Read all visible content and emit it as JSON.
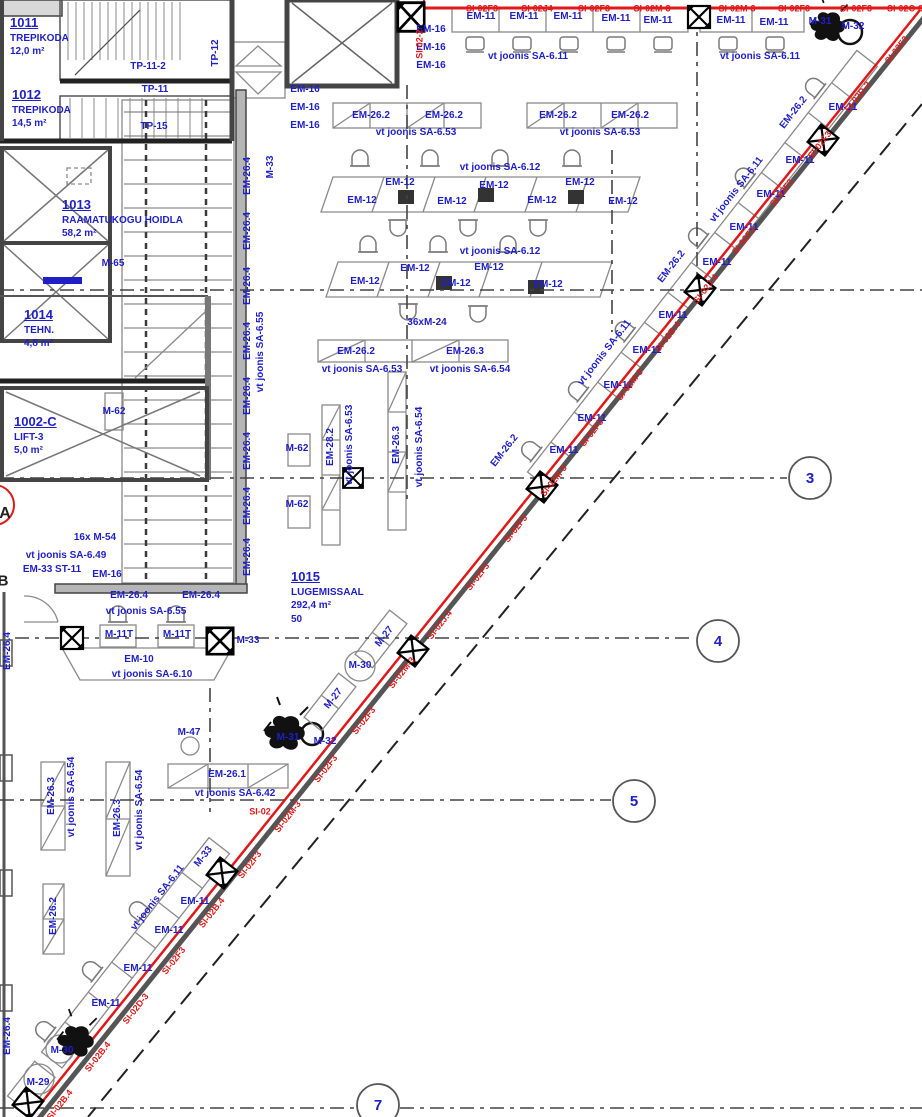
{
  "meta": {
    "type": "architectural-floor-plan",
    "width": 922,
    "height": 1117
  },
  "colors": {
    "blue": "#1f1fc8",
    "red": "#e01a1a",
    "dark": "#222"
  },
  "rooms": [
    {
      "number": "1011",
      "lines": [
        "TREPIKODA",
        "12,0 m²"
      ],
      "x": 10,
      "y": 16
    },
    {
      "number": "1012",
      "lines": [
        "TREPIKODA",
        "14,5 m²"
      ],
      "x": 12,
      "y": 88
    },
    {
      "number": "1013",
      "lines": [
        "RAAMATUKOGU HOIDLA",
        "58,2 m²"
      ],
      "x": 62,
      "y": 198
    },
    {
      "number": "1014",
      "lines": [
        "TEHN.",
        "4,8 m²"
      ],
      "x": 24,
      "y": 308
    },
    {
      "number": "1002-C",
      "lines": [
        "LIFT-3",
        "5,0 m²"
      ],
      "x": 14,
      "y": 415
    },
    {
      "number": "1015",
      "lines": [
        "LUGEMISSAAL",
        "292,4 m²",
        "50"
      ],
      "x": 291,
      "y": 570
    }
  ],
  "grid_bubbles": [
    {
      "label": "3",
      "x": 810,
      "y": 478
    },
    {
      "label": "4",
      "x": 718,
      "y": 641
    },
    {
      "label": "5",
      "x": 634,
      "y": 801
    },
    {
      "label": "7",
      "x": 378,
      "y": 1105
    }
  ],
  "labels": [
    {
      "t": "TP-11-2",
      "x": 148,
      "y": 67
    },
    {
      "t": "TP-11",
      "x": 155,
      "y": 90
    },
    {
      "t": "TP-15",
      "x": 154,
      "y": 127
    },
    {
      "t": "TP-12",
      "x": 216,
      "y": 53,
      "r": -90
    },
    {
      "t": "M-65",
      "x": 113,
      "y": 264
    },
    {
      "t": "M-62",
      "x": 114,
      "y": 412
    },
    {
      "t": "M-62",
      "x": 297,
      "y": 449
    },
    {
      "t": "M-62",
      "x": 297,
      "y": 505
    },
    {
      "t": "M-33",
      "x": 271,
      "y": 167,
      "r": -90
    },
    {
      "t": "EM-26.4",
      "x": 248,
      "y": 176,
      "r": -90
    },
    {
      "t": "EM-26.4",
      "x": 248,
      "y": 231,
      "r": -90
    },
    {
      "t": "EM-26.4",
      "x": 248,
      "y": 286,
      "r": -90
    },
    {
      "t": "EM-26.4",
      "x": 248,
      "y": 341,
      "r": -90
    },
    {
      "t": "EM-26.4",
      "x": 248,
      "y": 396,
      "r": -90
    },
    {
      "t": "EM-26.4",
      "x": 248,
      "y": 451,
      "r": -90
    },
    {
      "t": "EM-26.4",
      "x": 248,
      "y": 506,
      "r": -90
    },
    {
      "t": "EM-26.4",
      "x": 248,
      "y": 557,
      "r": -90
    },
    {
      "t": "vt joonis SA-6.55",
      "x": 261,
      "y": 352,
      "r": -90
    },
    {
      "t": "EM-16",
      "x": 431,
      "y": 30
    },
    {
      "t": "EM-16",
      "x": 431,
      "y": 48
    },
    {
      "t": "EM-16",
      "x": 431,
      "y": 66
    },
    {
      "t": "EM-16",
      "x": 305,
      "y": 90
    },
    {
      "t": "EM-16",
      "x": 305,
      "y": 108
    },
    {
      "t": "EM-16",
      "x": 305,
      "y": 126
    },
    {
      "t": "EM-26.2",
      "x": 371,
      "y": 116
    },
    {
      "t": "EM-26.2",
      "x": 444,
      "y": 116
    },
    {
      "t": "vt joonis SA-6.53",
      "x": 416,
      "y": 133
    },
    {
      "t": "EM-26.2",
      "x": 558,
      "y": 116
    },
    {
      "t": "EM-26.2",
      "x": 630,
      "y": 116
    },
    {
      "t": "vt joonis SA-6.53",
      "x": 600,
      "y": 133
    },
    {
      "t": "EM-11",
      "x": 481,
      "y": 17
    },
    {
      "t": "EM-11",
      "x": 524,
      "y": 17
    },
    {
      "t": "EM-11",
      "x": 568,
      "y": 17
    },
    {
      "t": "EM-11",
      "x": 616,
      "y": 19
    },
    {
      "t": "EM-11",
      "x": 658,
      "y": 21
    },
    {
      "t": "EM-11",
      "x": 731,
      "y": 21
    },
    {
      "t": "EM-11",
      "x": 774,
      "y": 23
    },
    {
      "t": "vt joonis SA-6.11",
      "x": 528,
      "y": 57
    },
    {
      "t": "vt joonis SA-6.11",
      "x": 760,
      "y": 57
    },
    {
      "t": "M-31",
      "x": 820,
      "y": 22
    },
    {
      "t": "M-32",
      "x": 853,
      "y": 27
    },
    {
      "t": "vt joonis SA-6.12",
      "x": 500,
      "y": 168
    },
    {
      "t": "EM-12",
      "x": 400,
      "y": 183
    },
    {
      "t": "EM-12",
      "x": 362,
      "y": 201
    },
    {
      "t": "EM-12",
      "x": 452,
      "y": 202
    },
    {
      "t": "EM-12",
      "x": 494,
      "y": 186
    },
    {
      "t": "EM-12",
      "x": 542,
      "y": 201
    },
    {
      "t": "EM-12",
      "x": 580,
      "y": 183
    },
    {
      "t": "EM-12",
      "x": 623,
      "y": 202
    },
    {
      "t": "vt joonis SA-6.12",
      "x": 500,
      "y": 252
    },
    {
      "t": "EM-12",
      "x": 415,
      "y": 269
    },
    {
      "t": "EM-12",
      "x": 365,
      "y": 282
    },
    {
      "t": "EM-12",
      "x": 456,
      "y": 284
    },
    {
      "t": "EM-12",
      "x": 489,
      "y": 268
    },
    {
      "t": "EM-12",
      "x": 548,
      "y": 285
    },
    {
      "t": "36xM-24",
      "x": 427,
      "y": 323
    },
    {
      "t": "EM-26.2",
      "x": 356,
      "y": 352
    },
    {
      "t": "EM-26.3",
      "x": 465,
      "y": 352
    },
    {
      "t": "vt joonis SA-6.53",
      "x": 362,
      "y": 370
    },
    {
      "t": "vt joonis SA-6.54",
      "x": 470,
      "y": 370
    },
    {
      "t": "EM-28.2",
      "x": 331,
      "y": 447,
      "r": -90
    },
    {
      "t": "vt joonis SA-6.53",
      "x": 350,
      "y": 445,
      "r": -90
    },
    {
      "t": "EM-26.3",
      "x": 397,
      "y": 445,
      "r": -90
    },
    {
      "t": "vt joonis SA-6.54",
      "x": 420,
      "y": 447,
      "r": -90
    },
    {
      "t": "16x M-54",
      "x": 95,
      "y": 538
    },
    {
      "t": "vt joonis SA-6.49",
      "x": 66,
      "y": 556
    },
    {
      "t": "EM-33 ST-11",
      "x": 52,
      "y": 570
    },
    {
      "t": "EM-16",
      "x": 107,
      "y": 575
    },
    {
      "t": "EM-26.4",
      "x": 129,
      "y": 596
    },
    {
      "t": "EM-26.4",
      "x": 201,
      "y": 596
    },
    {
      "t": "vt joonis SA-6.55",
      "x": 146,
      "y": 612
    },
    {
      "t": "M-11T",
      "x": 119,
      "y": 635
    },
    {
      "t": "M-11T",
      "x": 177,
      "y": 635
    },
    {
      "t": "M-33",
      "x": 248,
      "y": 641
    },
    {
      "t": "EM-10",
      "x": 139,
      "y": 660
    },
    {
      "t": "vt joonis SA-6.10",
      "x": 152,
      "y": 675
    },
    {
      "t": "EM-26.4",
      "x": 8,
      "y": 651,
      "r": -90
    },
    {
      "t": "A",
      "x": 5,
      "y": 514,
      "c": "dark",
      "s": 16
    },
    {
      "t": "B",
      "x": 3,
      "y": 581,
      "c": "dark",
      "s": 15
    },
    {
      "t": "M-27",
      "x": 385,
      "y": 637,
      "r": -52
    },
    {
      "t": "M-30",
      "x": 360,
      "y": 666
    },
    {
      "t": "M-27",
      "x": 334,
      "y": 699,
      "r": -52
    },
    {
      "t": "M-31",
      "x": 288,
      "y": 738
    },
    {
      "t": "M-32",
      "x": 325,
      "y": 742
    },
    {
      "t": "M-47",
      "x": 189,
      "y": 733
    },
    {
      "t": "EM-26.1",
      "x": 227,
      "y": 775
    },
    {
      "t": "vt joonis SA-6.42",
      "x": 235,
      "y": 794
    },
    {
      "t": "EM-11",
      "x": 843,
      "y": 108
    },
    {
      "t": "EM-11",
      "x": 800,
      "y": 161
    },
    {
      "t": "EM-11",
      "x": 771,
      "y": 195
    },
    {
      "t": "EM-11",
      "x": 744,
      "y": 228
    },
    {
      "t": "EM-11",
      "x": 717,
      "y": 263
    },
    {
      "t": "vt joonis SA-6.11",
      "x": 737,
      "y": 190,
      "r": -52
    },
    {
      "t": "EM-26.2",
      "x": 794,
      "y": 113,
      "r": -52
    },
    {
      "t": "EM-26.2",
      "x": 672,
      "y": 267,
      "r": -52
    },
    {
      "t": "EM-11",
      "x": 673,
      "y": 316
    },
    {
      "t": "EM-11",
      "x": 647,
      "y": 351
    },
    {
      "t": "EM-11",
      "x": 618,
      "y": 386
    },
    {
      "t": "EM-11",
      "x": 592,
      "y": 419
    },
    {
      "t": "EM-11",
      "x": 564,
      "y": 451
    },
    {
      "t": "vt joonis SA-6.11",
      "x": 605,
      "y": 353,
      "r": -52
    },
    {
      "t": "EM-26.2",
      "x": 505,
      "y": 451,
      "r": -52
    },
    {
      "t": "M-33",
      "x": 204,
      "y": 857,
      "r": -52
    },
    {
      "t": "vt joonis SA-6.11",
      "x": 158,
      "y": 898,
      "r": -52
    },
    {
      "t": "EM-11",
      "x": 195,
      "y": 902
    },
    {
      "t": "EM-11",
      "x": 169,
      "y": 931
    },
    {
      "t": "EM-11",
      "x": 138,
      "y": 969
    },
    {
      "t": "EM-11",
      "x": 106,
      "y": 1004
    },
    {
      "t": "EM-26.2",
      "x": 54,
      "y": 916,
      "r": -90
    },
    {
      "t": "EM-26.3",
      "x": 52,
      "y": 796,
      "r": -90
    },
    {
      "t": "vt joonis SA-6.54",
      "x": 72,
      "y": 797,
      "r": -90
    },
    {
      "t": "EM-26.3",
      "x": 118,
      "y": 818,
      "r": -90
    },
    {
      "t": "vt joonis SA-6.54",
      "x": 140,
      "y": 810,
      "r": -90
    },
    {
      "t": "M-30",
      "x": 62,
      "y": 1051
    },
    {
      "t": "M-29",
      "x": 38,
      "y": 1083
    },
    {
      "t": "EM-26.4",
      "x": 8,
      "y": 1036,
      "r": -90
    },
    {
      "t": "SI-02F3",
      "x": 482,
      "y": 9,
      "c": "red",
      "s": 9
    },
    {
      "t": "SI-02J4",
      "x": 537,
      "y": 9,
      "c": "red",
      "s": 9
    },
    {
      "t": "SI-02F3",
      "x": 594,
      "y": 9,
      "c": "red",
      "s": 9
    },
    {
      "t": "SI-02M-3",
      "x": 652,
      "y": 9,
      "c": "red",
      "s": 9
    },
    {
      "t": "SI-02M-3",
      "x": 737,
      "y": 9,
      "c": "red",
      "s": 9
    },
    {
      "t": "SI-02F3",
      "x": 794,
      "y": 9,
      "c": "red",
      "s": 9
    },
    {
      "t": "SI-02F3",
      "x": 856,
      "y": 9,
      "c": "red",
      "s": 9
    },
    {
      "t": "SI-02C-3",
      "x": 905,
      "y": 9,
      "c": "red",
      "s": 9
    },
    {
      "t": "SI-02-2",
      "x": 420,
      "y": 44,
      "r": -90,
      "c": "red",
      "s": 9
    },
    {
      "t": "SI-02",
      "x": 260,
      "y": 812,
      "c": "red",
      "s": 9
    },
    {
      "t": "SI-02F3",
      "x": 897,
      "y": 50,
      "r": -52,
      "c": "red",
      "s": 9
    },
    {
      "t": "SI-02D-2",
      "x": 858,
      "y": 97,
      "r": -52,
      "c": "red",
      "s": 9
    },
    {
      "t": "SI-02F3",
      "x": 820,
      "y": 145,
      "r": -52,
      "c": "red",
      "s": 9
    },
    {
      "t": "SI-02F3",
      "x": 782,
      "y": 193,
      "r": -52,
      "c": "red",
      "s": 9
    },
    {
      "t": "SI-02F3",
      "x": 744,
      "y": 241,
      "r": -52,
      "c": "red",
      "s": 9
    },
    {
      "t": "SI-02J.4",
      "x": 706,
      "y": 289,
      "r": -52,
      "c": "red",
      "s": 9
    },
    {
      "t": "SI-02B.4",
      "x": 668,
      "y": 337,
      "r": -52,
      "c": "red",
      "s": 9
    },
    {
      "t": "SI-02M-3",
      "x": 630,
      "y": 385,
      "r": -52,
      "c": "red",
      "s": 9
    },
    {
      "t": "SI-02F3",
      "x": 592,
      "y": 433,
      "r": -52,
      "c": "red",
      "s": 9
    },
    {
      "t": "SI-02M-3",
      "x": 554,
      "y": 481,
      "r": -52,
      "c": "red",
      "s": 9
    },
    {
      "t": "SI-02F3",
      "x": 516,
      "y": 529,
      "r": -52,
      "c": "red",
      "s": 9
    },
    {
      "t": "SI-02F3",
      "x": 478,
      "y": 577,
      "r": -52,
      "c": "red",
      "s": 9
    },
    {
      "t": "SI-02J.4",
      "x": 440,
      "y": 625,
      "r": -52,
      "c": "red",
      "s": 9
    },
    {
      "t": "SI-02M-3",
      "x": 402,
      "y": 673,
      "r": -52,
      "c": "red",
      "s": 9
    },
    {
      "t": "SI-02F3",
      "x": 364,
      "y": 721,
      "r": -52,
      "c": "red",
      "s": 9
    },
    {
      "t": "SI-02F3",
      "x": 326,
      "y": 769,
      "r": -52,
      "c": "red",
      "s": 9
    },
    {
      "t": "SI-02M-3",
      "x": 288,
      "y": 817,
      "r": -52,
      "c": "red",
      "s": 9
    },
    {
      "t": "SI-02F3",
      "x": 250,
      "y": 865,
      "r": -52,
      "c": "red",
      "s": 9
    },
    {
      "t": "SI-02B.4",
      "x": 212,
      "y": 913,
      "r": -52,
      "c": "red",
      "s": 9
    },
    {
      "t": "SI-02F3",
      "x": 174,
      "y": 961,
      "r": -52,
      "c": "red",
      "s": 9
    },
    {
      "t": "SI-02D-3",
      "x": 136,
      "y": 1009,
      "r": -52,
      "c": "red",
      "s": 9
    },
    {
      "t": "SI-02B.4",
      "x": 98,
      "y": 1057,
      "r": -52,
      "c": "red",
      "s": 9
    },
    {
      "t": "SI-02B.4",
      "x": 60,
      "y": 1105,
      "r": -52,
      "c": "red",
      "s": 9
    }
  ]
}
